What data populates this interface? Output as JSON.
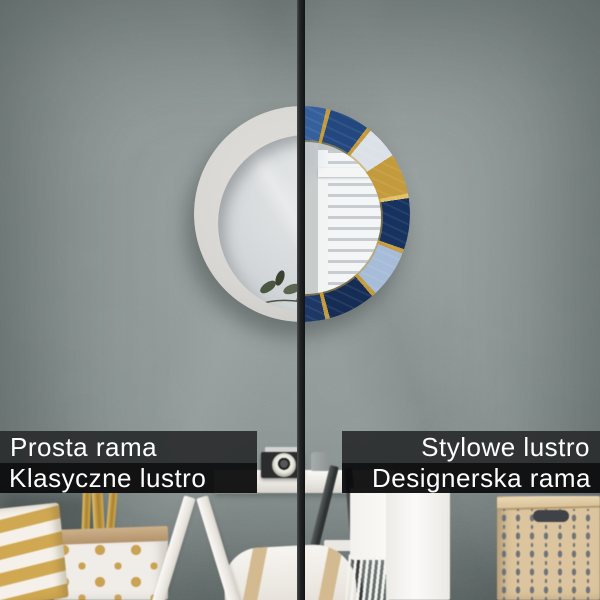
{
  "labels": {
    "left": {
      "line1": "Prosta rama",
      "line2": "Klasyczne lustro"
    },
    "right": {
      "line1": "Stylowe lustro",
      "line2": "Designerska rama"
    }
  },
  "palette": {
    "wall": "#8a9493",
    "wall_light": "#9aa3a1",
    "wall_dark": "#67706f",
    "bar_dark": "#2c2e2f",
    "bar_black": "#0c0c0d",
    "text_white": "#ffffff",
    "frame_white": "#d8d6d2",
    "glass_left": "#d7dadc",
    "navy_deep": "#16325f",
    "navy": "#23477f",
    "blue_mid": "#35609c",
    "blue_light": "#a6bcd8",
    "marble_white": "#dce1e8",
    "gold": "#c49b3c",
    "gold_bright": "#e3c06a",
    "divider_dark": "#1b1d1e",
    "shelf_white": "#f2efea",
    "kraft_tan": "#c2a37a",
    "gold_stripe": "#d0a851",
    "box_tan": "#dcc59e",
    "box_pattern": "#6f747a",
    "leaf_green": "#4c5741"
  }
}
